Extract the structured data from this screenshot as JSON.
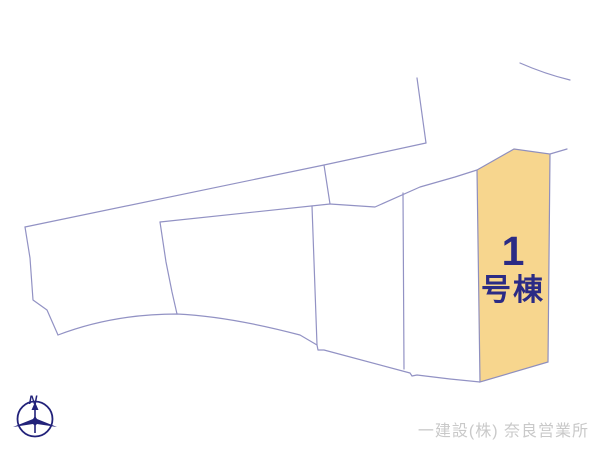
{
  "diagram": {
    "type": "real-estate-site-plan",
    "background_color": "#ffffff",
    "boundary_line_color": "#9292c4",
    "highlighted_lot": {
      "full_label": "1号棟",
      "label_line1": "1",
      "label_line2": "号棟",
      "fill_color": "#f7d68e",
      "label_color": "#2b2b85"
    },
    "compass": {
      "label": "N",
      "color": "#22227a"
    },
    "credit": {
      "text": "一建設(株) 奈良営業所",
      "color": "#c9c9c9"
    }
  }
}
